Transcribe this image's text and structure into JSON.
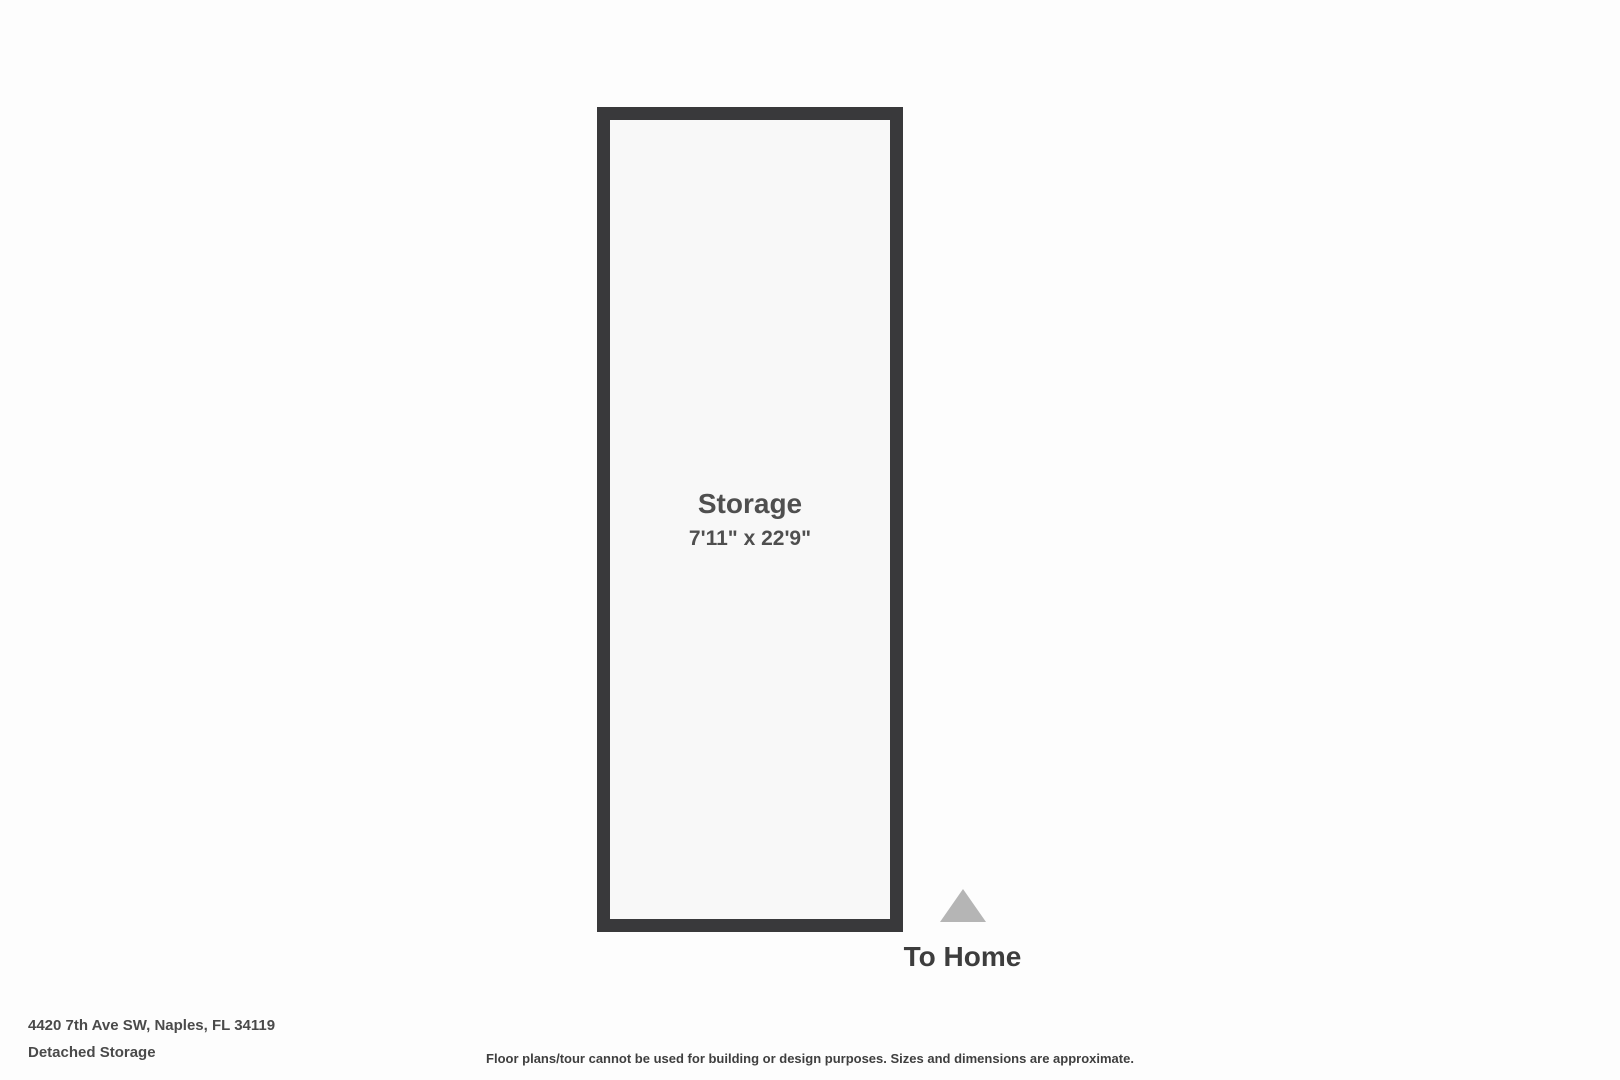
{
  "floorplan": {
    "room": {
      "name": "Storage",
      "dimensions": "7'11\" x 22'9\""
    },
    "compass": {
      "label": "To Home",
      "arrow_icon": "triangle-up-icon"
    },
    "colors": {
      "wall": "#39393b",
      "room_fill": "#f8f8f8",
      "background": "#fdfdfd",
      "arrow": "#b5b5b5",
      "text": "#4a4a4a"
    }
  },
  "footer": {
    "address": "4420 7th Ave SW, Naples, FL 34119",
    "plan_title": "Detached Storage",
    "disclaimer": "Floor plans/tour cannot be used for building or design purposes. Sizes and dimensions are approximate."
  }
}
